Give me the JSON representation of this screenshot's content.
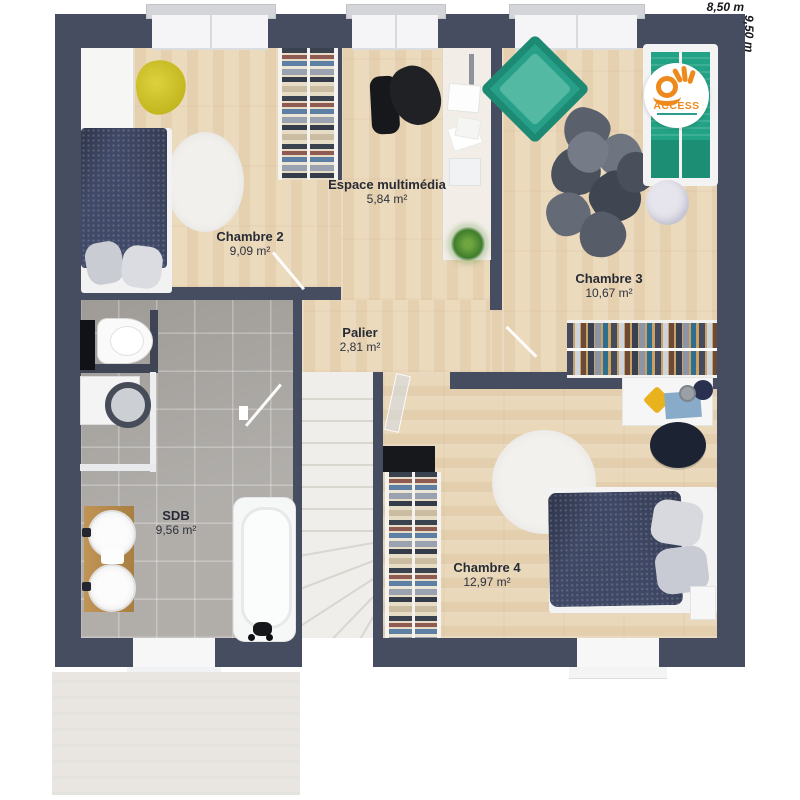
{
  "dimensions": {
    "width_label": "8,50 m",
    "height_label": "9,50 m"
  },
  "rooms": [
    {
      "name": "Chambre 2",
      "area": "9,09 m²"
    },
    {
      "name": "Espace multimédia",
      "area": "5,84 m²"
    },
    {
      "name": "Chambre 3",
      "area": "10,67 m²"
    },
    {
      "name": "Palier",
      "area": "2,81 m²"
    },
    {
      "name": "SDB",
      "area": "9,56 m²"
    },
    {
      "name": "Chambre 4",
      "area": "12,97 m²"
    }
  ],
  "logo": {
    "text": "ACCESS"
  },
  "colors": {
    "wall": "#474d60",
    "wood": "#ecdabd",
    "tile": "#a8a5a1",
    "logo_orange": "#ee8a1c",
    "logo_teal": "#2a9d8f",
    "bed_blue": "#3f4865",
    "bed_green": "#23a385",
    "chair_yellow": "#cdbf25"
  }
}
